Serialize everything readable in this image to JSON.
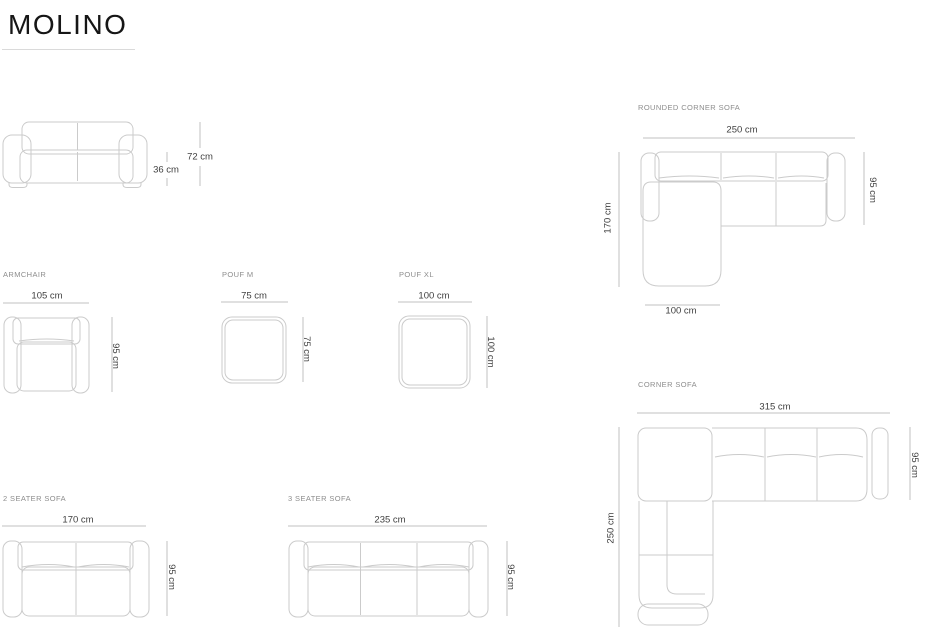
{
  "title": "MOLINO",
  "colors": {
    "background": "#ffffff",
    "title_text": "#161616",
    "label_text": "#8d8d8d",
    "dim_text": "#3f3f3f",
    "outline": "#cbcbcb",
    "dim_line": "#c2c2c2",
    "divider": "#dadada"
  },
  "figures": {
    "front_view": {
      "height": "72 cm",
      "seat_height": "36 cm"
    },
    "rounded_corner_sofa": {
      "label": "ROUNDED CORNER SOFA",
      "width": "250 cm",
      "depth": "95 cm",
      "total_depth": "170 cm",
      "chaise_width": "100 cm"
    },
    "armchair": {
      "label": "ARMCHAIR",
      "width": "105 cm",
      "depth": "95 cm"
    },
    "pouf_m": {
      "label": "POUF M",
      "width": "75 cm",
      "depth": "75 cm"
    },
    "pouf_xl": {
      "label": "POUF XL",
      "width": "100 cm",
      "depth": "100 cm"
    },
    "corner_sofa": {
      "label": "CORNER SOFA",
      "width": "315 cm",
      "depth": "95 cm",
      "total_depth": "250 cm"
    },
    "two_seater": {
      "label": "2 SEATER SOFA",
      "width": "170 cm",
      "depth": "95 cm"
    },
    "three_seater": {
      "label": "3 SEATER SOFA",
      "width": "235 cm",
      "depth": "95 cm"
    }
  }
}
